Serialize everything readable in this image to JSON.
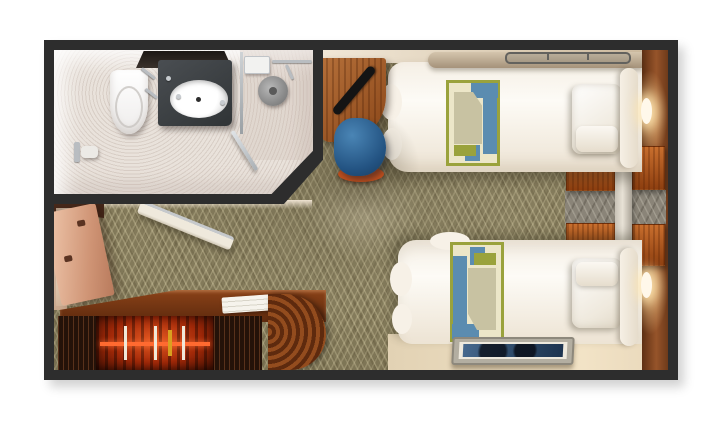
{
  "labels": {
    "frame": "Stateroom outer walls",
    "carpet": "Patterned olive carpet",
    "bathroom": "Bathroom",
    "toilet": "Toilet",
    "shelf": "Black wall shelf",
    "vanity": "Dark vanity counter",
    "sink": "Oval sink basin",
    "glass_panel": "Glass shower partition",
    "shower_head": "Shower head",
    "soap_dish": "Shower shelf",
    "glass_door": "Glass shower door",
    "towel_bar": "Towel bar",
    "paper_holder": "Toilet paper holder",
    "top_wall": "Top cabin wall",
    "left_wall": "Left cabin wall",
    "right_wall": "Wood-paneled headboard wall",
    "bottom_floor": "Floor strip along lower wall",
    "lamp_top": "Reading lamp (bed 1)",
    "lamp_bottom": "Reading lamp (bed 2)",
    "bed_top": "Twin bed 1",
    "bed_bottom": "Twin bed 2",
    "bolster": "Wall bolster cushion",
    "rail": "Wall rail above bed",
    "runner_top": "Geometric bed runner (bed 1)",
    "runner_bottom": "Geometric bed runner (bed 2)",
    "pillow_top": "Pillow (bed 1)",
    "pillow_bottom": "Pillow (bed 2)",
    "headrest_top": "Headboard cushion (bed 1)",
    "headrest_bottom": "Headboard cushion (bed 2)",
    "nightstand": "Nightstand",
    "divider": "Bedside divider column",
    "gray_band": "Carpet strip between nightstands",
    "desk": "Curved wall desk",
    "tv": "Flat-screen TV",
    "chair": "Blue barrel chair",
    "chair_base": "Chair base trim",
    "wall_art": "Framed wall art",
    "closet_door": "Open closet door",
    "closet_glow": "Lit closet interior",
    "closet_top": "Closet cabinet top",
    "counter": "Wardrobe counter",
    "linens": "Folded linens",
    "end_cap": "Curved cabinet end",
    "wardrobe_open": "Open wardrobe with hanging clothes",
    "clothes_rod": "Clothes rod",
    "slat_panel": "Dark wood slat panel",
    "bathroom_door": "Open bathroom door",
    "door_handle": "Bathroom door handle"
  },
  "colors": {
    "frame": "#2d2d2d",
    "carpet_base": "#837a5a",
    "carpet_pattern": "#ddd4ab",
    "wall_beige": "#e7d9c1",
    "wood_dark": "#5e2a0e",
    "wood_mid": "#9a5a2a",
    "wood_bright": "#c96f2e",
    "bedding_white": "#f9f5ee",
    "runner_blue": "#5b8cb0",
    "runner_olive": "#9aa23c",
    "runner_cream": "#ece6c8",
    "runner_tan": "#c8c2a2",
    "chair_blue": "#2e6391",
    "chair_trim": "#c4501e",
    "red_glow": "#d0431a",
    "bathroom_floor": "#e9e2db",
    "vanity_gray": "#3f4245",
    "chrome": "#b9bdc1",
    "art_blue": "#3a6a9c",
    "lamp_glow": "#ffe8b4"
  }
}
